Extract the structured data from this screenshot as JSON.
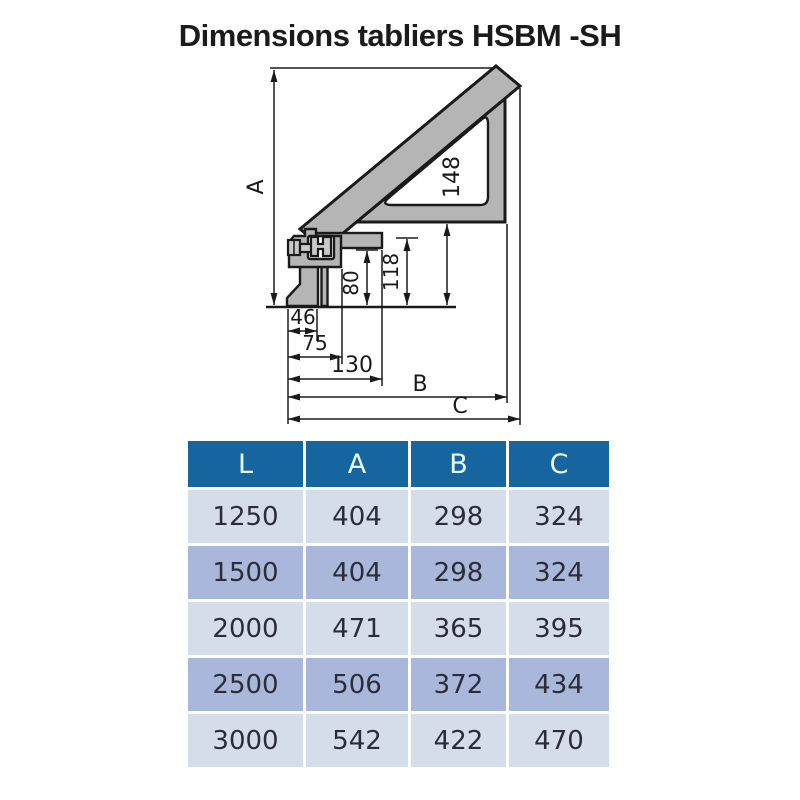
{
  "title": "Dimensions tabliers HSBM -SH",
  "diagram": {
    "dims": {
      "A": "A",
      "B": "B",
      "C": "C",
      "h148": "148",
      "h118": "118",
      "h80": "80",
      "w46": "46",
      "w75": "75",
      "w130": "130"
    },
    "colors": {
      "profile_fill": "#b5b5b5",
      "line": "#1a1a1a"
    }
  },
  "table": {
    "headers": [
      "L",
      "A",
      "B",
      "C"
    ],
    "rows": [
      [
        "1250",
        "404",
        "298",
        "324"
      ],
      [
        "1500",
        "404",
        "298",
        "324"
      ],
      [
        "2000",
        "471",
        "365",
        "395"
      ],
      [
        "2500",
        "506",
        "372",
        "434"
      ],
      [
        "3000",
        "542",
        "422",
        "470"
      ]
    ],
    "colors": {
      "header_bg": "#17659f",
      "header_text": "#e9fbfb",
      "row_light": "#d5ddeb",
      "row_dark": "#a9b8da",
      "cell_text": "#2b2d3a"
    }
  }
}
